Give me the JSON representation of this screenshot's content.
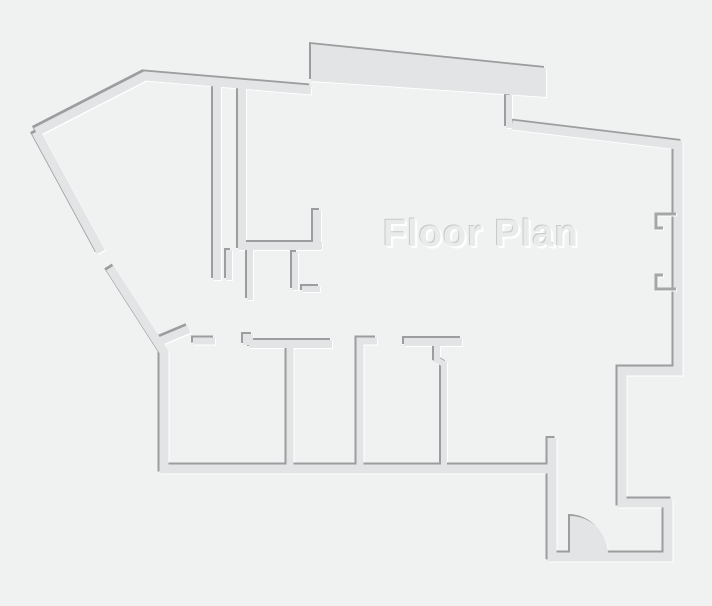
{
  "title": "Floor Plan",
  "canvas": {
    "width": 712,
    "height": 606
  },
  "colors": {
    "background": "#f0f1f1",
    "wall": "#e2e4e5",
    "edge_dark": "#9b9d9e",
    "edge_light": "#ffffff",
    "bracket": "#a4a6a7",
    "title_fill": "#e9eaea",
    "title_shadow": "#c7c9ca"
  }
}
